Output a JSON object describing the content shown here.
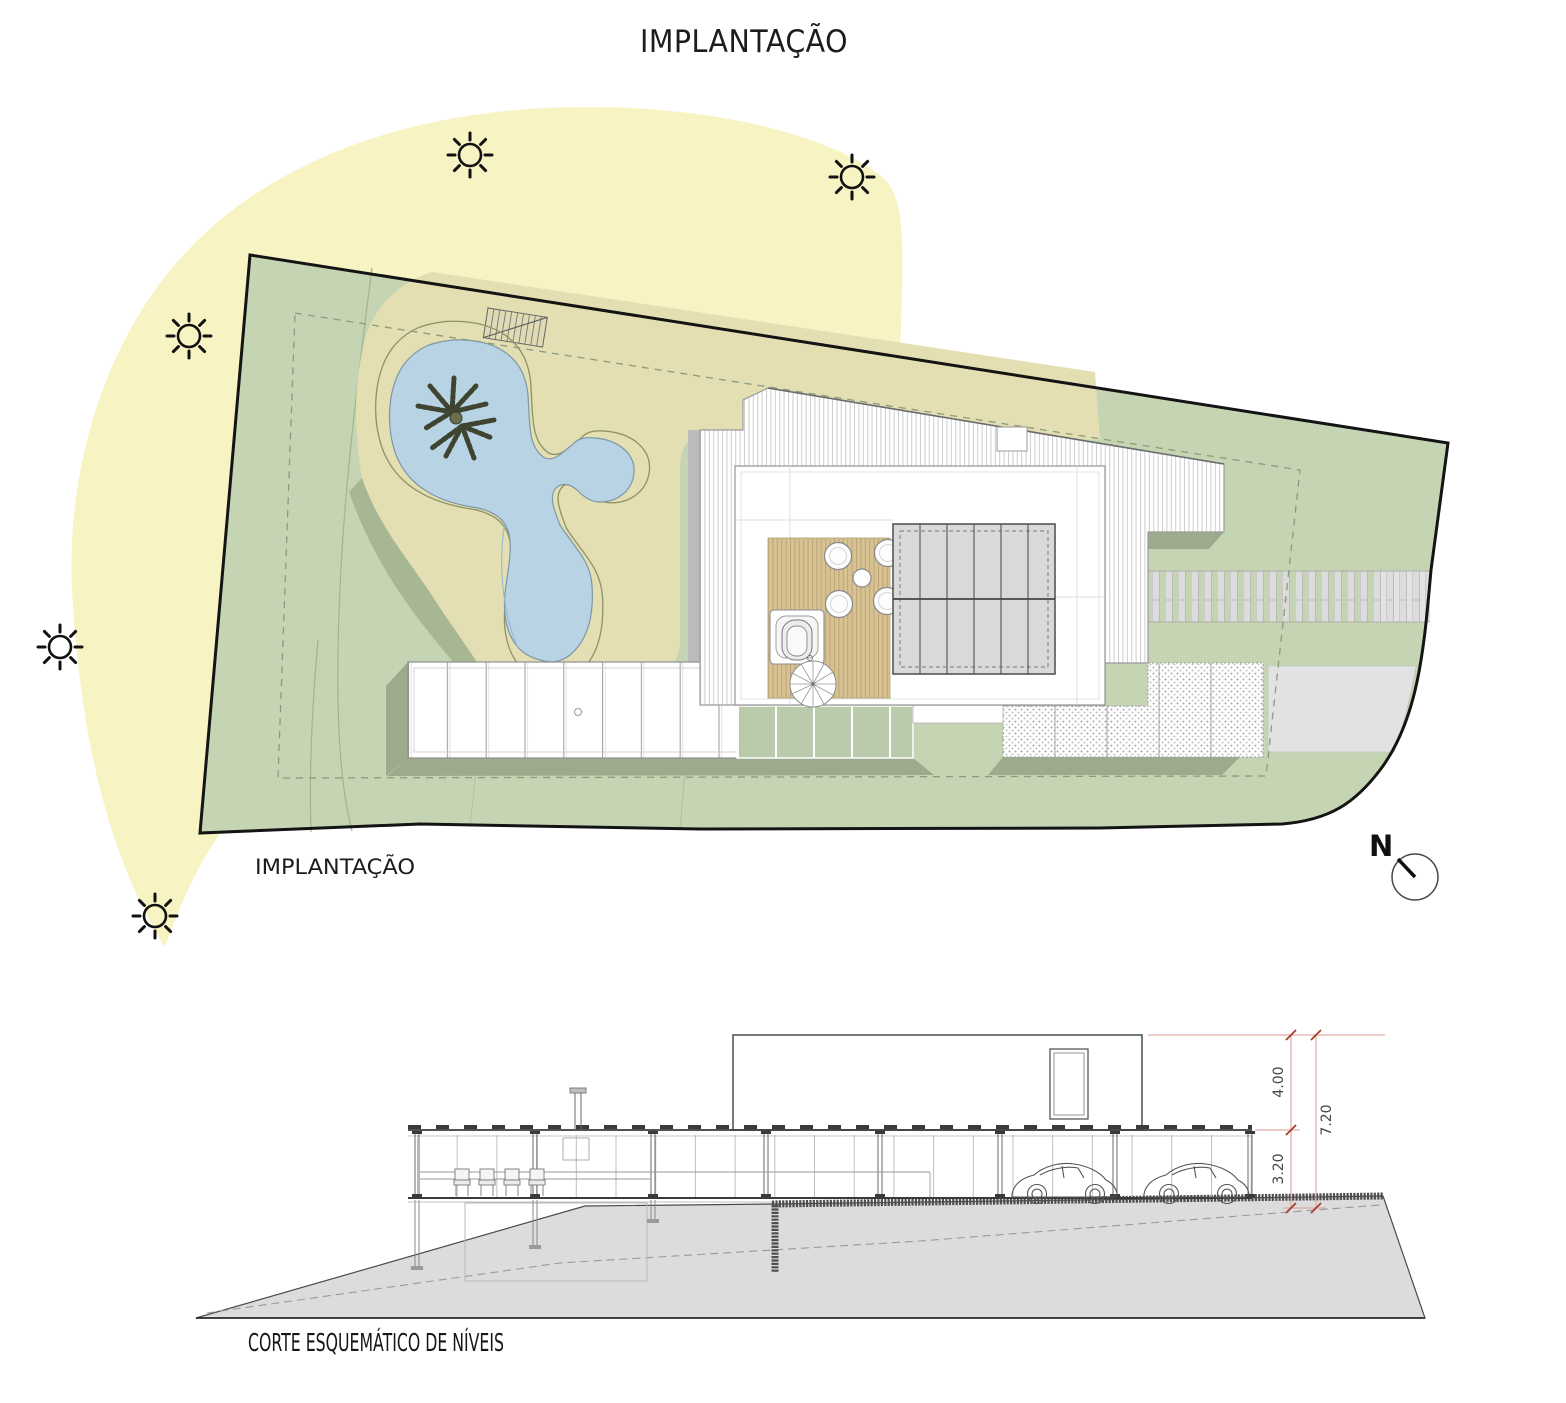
{
  "title": "IMPLANTAÇÃO",
  "plan": {
    "label": "IMPLANTAÇÃO",
    "north_label": "N",
    "sun_icon_count": 5
  },
  "section": {
    "label": "CORTE ESQUEMÁTICO DE NÍVEIS",
    "dimensions": {
      "upper": "4.00",
      "lower": "3.20",
      "total": "7.20"
    },
    "cars_visible": 2
  },
  "icons": {
    "sun": "sun-icon",
    "north_arrow": "north-arrow-icon",
    "palm_tree": "palm-tree-icon",
    "spiral_stair": "spiral-stair-icon"
  },
  "colors": {
    "sun_path_yellow": "#f7f3c3",
    "lawn_green": "#c5d5b4",
    "shadow_green": "#9cab8c",
    "sand_beige": "#e4dfb2",
    "pool_water": "#b7d3e4",
    "deck_wood": "#d7c292",
    "pergola_gray": "#d9d9d9",
    "terrain_gray": "#dcdcdc",
    "boundary_black": "#141414",
    "dimension_red": "#b23b32"
  }
}
